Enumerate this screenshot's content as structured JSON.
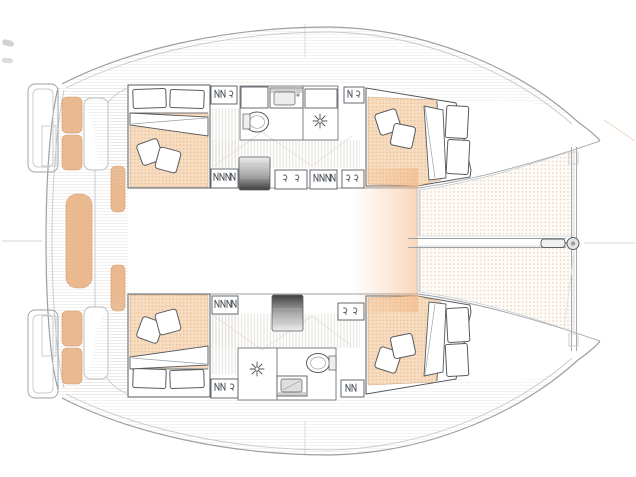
{
  "meta": {
    "label": "Catamaran interior layout floor plan, bow to the right, no text labels"
  },
  "colors": {
    "background": "#ffffff",
    "hull_outline": "#9aa0a4",
    "hull_outline_light": "#c6c9cb",
    "furniture_line": "#565b60",
    "cushion": "#eab990",
    "cushion_edge": "#d69a6c",
    "cabin_floor": "#f7dcbf",
    "cabin_floor_dot": "#e8c09a",
    "trampoline_bg": "#fefcf9",
    "trampoline_dot": "#ead0b4",
    "deck_line": "#d9d4cd",
    "corridor_line": "#ddd8d2",
    "steps_dark": "#3f3f3f",
    "glow": "#f2ac74",
    "crosshair": "#d6d6d6"
  },
  "areas": [
    {
      "id": "port-aft-cabin",
      "contents": [
        "double-bed",
        "bed-pillows",
        "floor-cushions"
      ]
    },
    {
      "id": "port-bathroom",
      "contents": [
        "sink",
        "toilet",
        "shower"
      ]
    },
    {
      "id": "port-forward-cabin",
      "contents": [
        "double-bed",
        "bed-pillows",
        "floor-cushions"
      ]
    },
    {
      "id": "starboard-aft-cabin",
      "contents": [
        "double-bed",
        "bed-pillows",
        "floor-cushions"
      ]
    },
    {
      "id": "starboard-bathroom",
      "contents": [
        "sink",
        "toilet",
        "shower"
      ]
    },
    {
      "id": "starboard-forward-cabin",
      "contents": [
        "double-bed",
        "bed-pillows",
        "floor-cushions"
      ]
    },
    {
      "id": "cockpit",
      "contents": [
        "bench-cushions",
        "aft-bench",
        "seat-modules"
      ]
    },
    {
      "id": "swim-platforms",
      "contents": [
        "port-transom",
        "starboard-transom"
      ]
    },
    {
      "id": "companionways",
      "contents": [
        "port-steps",
        "starboard-steps"
      ]
    },
    {
      "id": "foredeck",
      "contents": [
        "trampoline-port",
        "trampoline-starboard",
        "forward-crossbeam",
        "bowsprit-fitting"
      ]
    }
  ],
  "icons": [
    "deck-hatch-icon",
    "opening-port-icon",
    "shower-head-icon",
    "toilet-icon",
    "sink-icon",
    "pillow-icon",
    "steps-icon",
    "bowsprit-icon"
  ]
}
